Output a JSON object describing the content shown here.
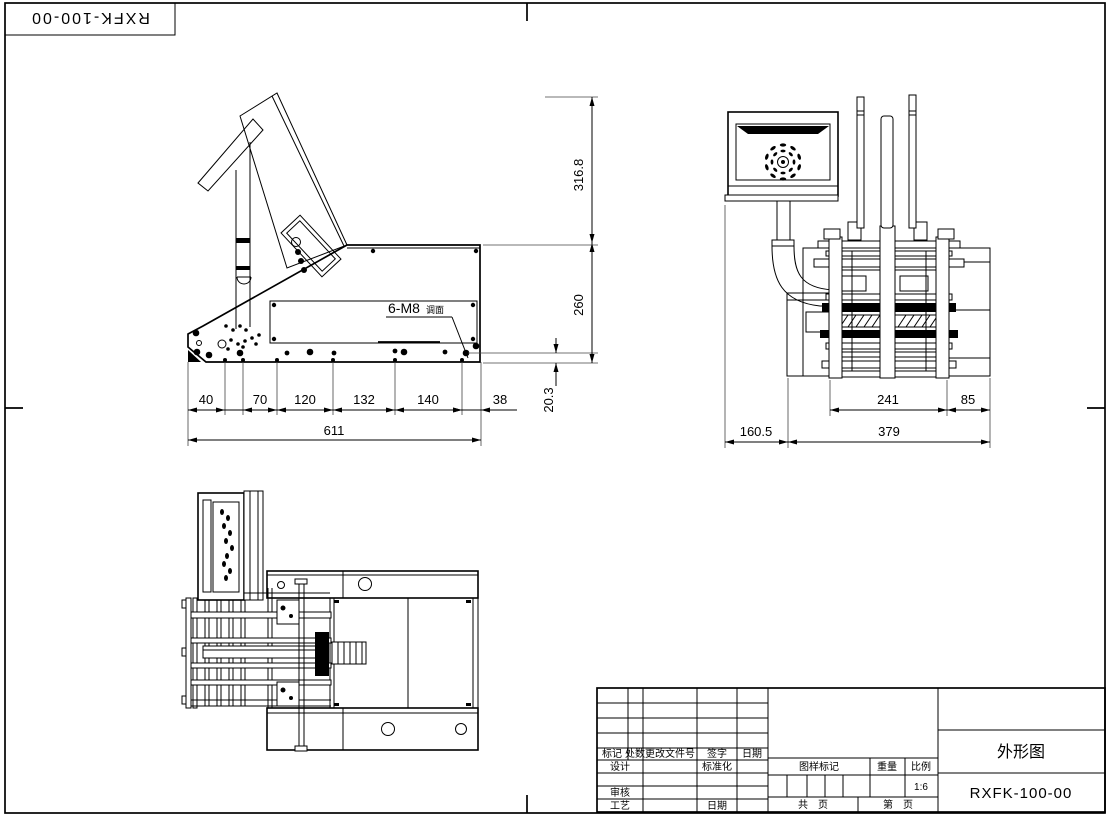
{
  "sheet": {
    "corner_stamp": "RXFK-100-00"
  },
  "side_view": {
    "note_prefix": "6-M8",
    "note_suffix": "调面",
    "dim_chain": [
      "40",
      "70",
      "120",
      "132",
      "140",
      "38"
    ],
    "dim_total": "611",
    "dim_height_top": "316.8",
    "dim_height_bottom": "260",
    "dim_offset": "20.3"
  },
  "front_view": {
    "dim_width_inner": "241",
    "dim_width_side": "85",
    "dim_monitor": "160.5",
    "dim_body": "379"
  },
  "title_block": {
    "rev_headers": [
      "标记",
      "处数",
      "更改文件号",
      "签字",
      "日期"
    ],
    "row_design": "设计",
    "row_standard": "标准化",
    "row_check": "审核",
    "row_process": "工艺",
    "row_date": "日期",
    "stamp_label": "图样标记",
    "weight_label": "重量",
    "scale_label": "比例",
    "scale_value": "1:6",
    "pages_total": "共　页",
    "pages_no": "第　页",
    "drawing_title": "外形图",
    "drawing_no": "RXFK-100-00"
  }
}
